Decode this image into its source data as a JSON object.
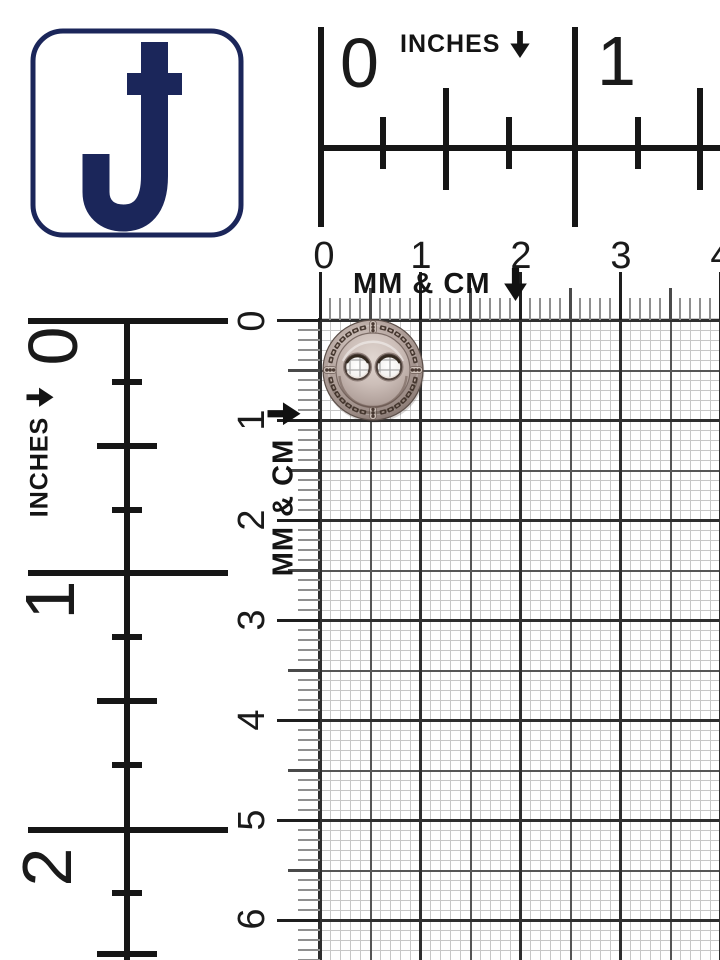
{
  "page": {
    "background": "#ffffff",
    "subject": "two-hole metal button on measurement grid"
  },
  "logo": {
    "letter": "J",
    "navy": "#1b265a"
  },
  "rulers": {
    "top_inches": {
      "label": "INCHES",
      "arrow_icon": "down-arrow",
      "numbers": [
        "0",
        "1"
      ]
    },
    "top_mm_cm": {
      "label": "MM & CM",
      "arrow_icon": "down-arrow",
      "numbers": [
        "0",
        "1",
        "2",
        "3",
        "4"
      ]
    },
    "left_inches": {
      "label": "INCHES",
      "arrow_icon": "down-arrow",
      "numbers": [
        "0",
        "1",
        "2"
      ]
    },
    "left_mm_cm": {
      "label": "MM & CM",
      "arrow_icon": "down-arrow",
      "numbers": [
        "0",
        "1",
        "2",
        "3",
        "4",
        "5",
        "6"
      ]
    }
  },
  "grid": {
    "background": "#ffffff",
    "mm_line_color": "#c7c7c7",
    "half_cm_line_color": "#565656",
    "cm_line_color": "#2f2f2f"
  },
  "button": {
    "type": "round-2-hole-metal-button",
    "metal_light": "#ddd2cb",
    "metal_mid": "#b4a49e",
    "metal_dark": "#82726c",
    "mark_color": "#473931"
  }
}
